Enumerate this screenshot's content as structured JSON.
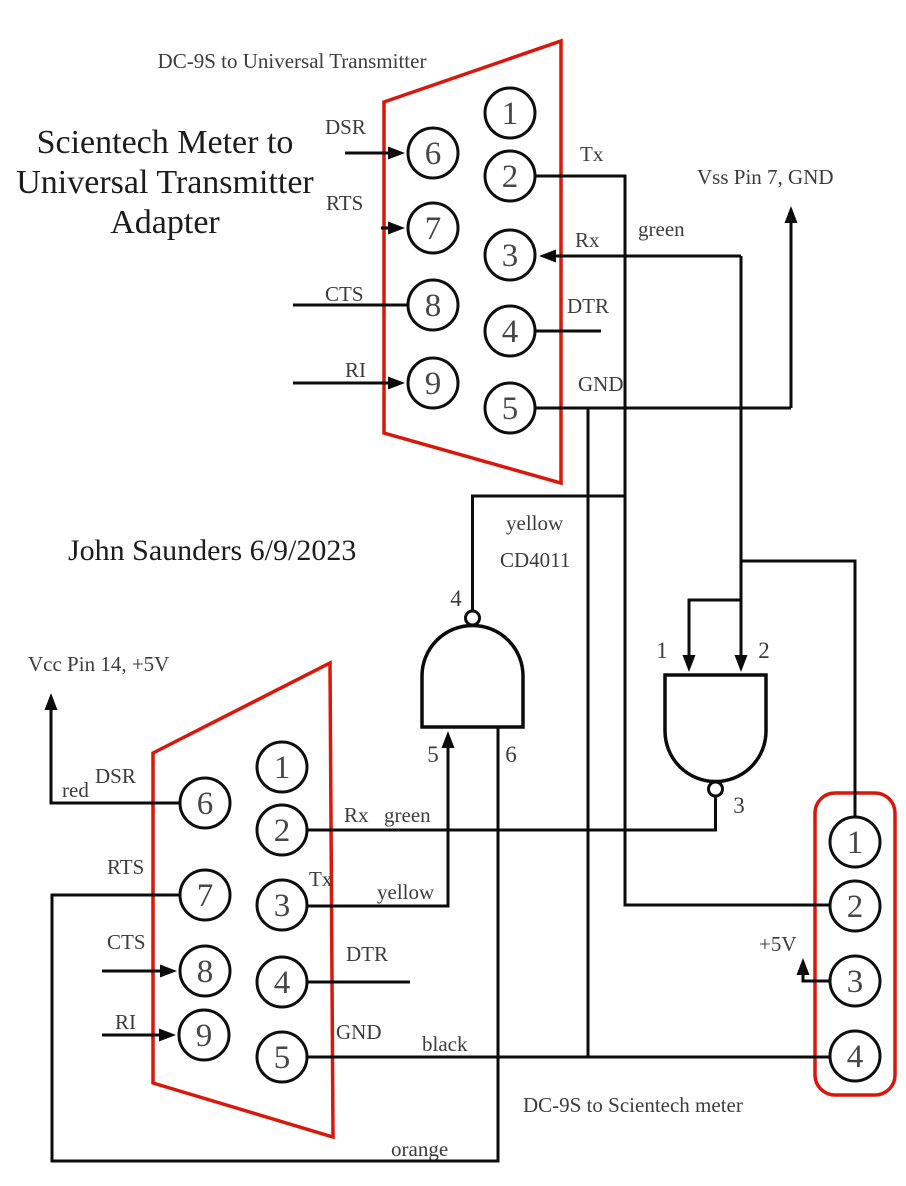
{
  "header": {
    "top_caption": "DC-9S to Universal Transmitter",
    "title_lines": [
      "Scientech Meter to",
      "Universal Transmitter",
      "Adapter"
    ],
    "author": "John Saunders 6/9/2023",
    "bottom_caption": "DC-9S to Scientech meter"
  },
  "colors": {
    "connector_red": "#d9170b",
    "wire_black": "#0b0b0b",
    "label_gray": "#3c3c3c"
  },
  "top_connector": {
    "pins": [
      "1",
      "2",
      "3",
      "4",
      "5",
      "6",
      "7",
      "8",
      "9"
    ],
    "labels": {
      "dsr": "DSR",
      "rts": "RTS",
      "cts": "CTS",
      "ri": "RI",
      "tx": "Tx",
      "rx": "Rx",
      "dtr": "DTR",
      "gnd": "GND",
      "green": "green",
      "vss": "Vss Pin 7, GND"
    }
  },
  "gates": {
    "chip": "CD4011",
    "yellow": "yellow",
    "gate1": {
      "out": "4",
      "in_a": "5",
      "in_b": "6"
    },
    "gate2": {
      "in_a": "1",
      "in_b": "2",
      "out": "3"
    }
  },
  "bottom_connector": {
    "pins": [
      "1",
      "2",
      "3",
      "4",
      "5",
      "6",
      "7",
      "8",
      "9"
    ],
    "labels": {
      "vcc": "Vcc Pin 14, +5V",
      "red": "red",
      "dsr": "DSR",
      "rts": "RTS",
      "cts": "CTS",
      "ri": "RI",
      "rx": "Rx",
      "green": "green",
      "tx": "Tx",
      "yellow": "yellow",
      "dtr": "DTR",
      "gnd": "GND",
      "black": "black",
      "orange": "orange"
    }
  },
  "meter_connector": {
    "pins": [
      "1",
      "2",
      "3",
      "4"
    ],
    "labels": {
      "plus5v": "+5V"
    }
  }
}
